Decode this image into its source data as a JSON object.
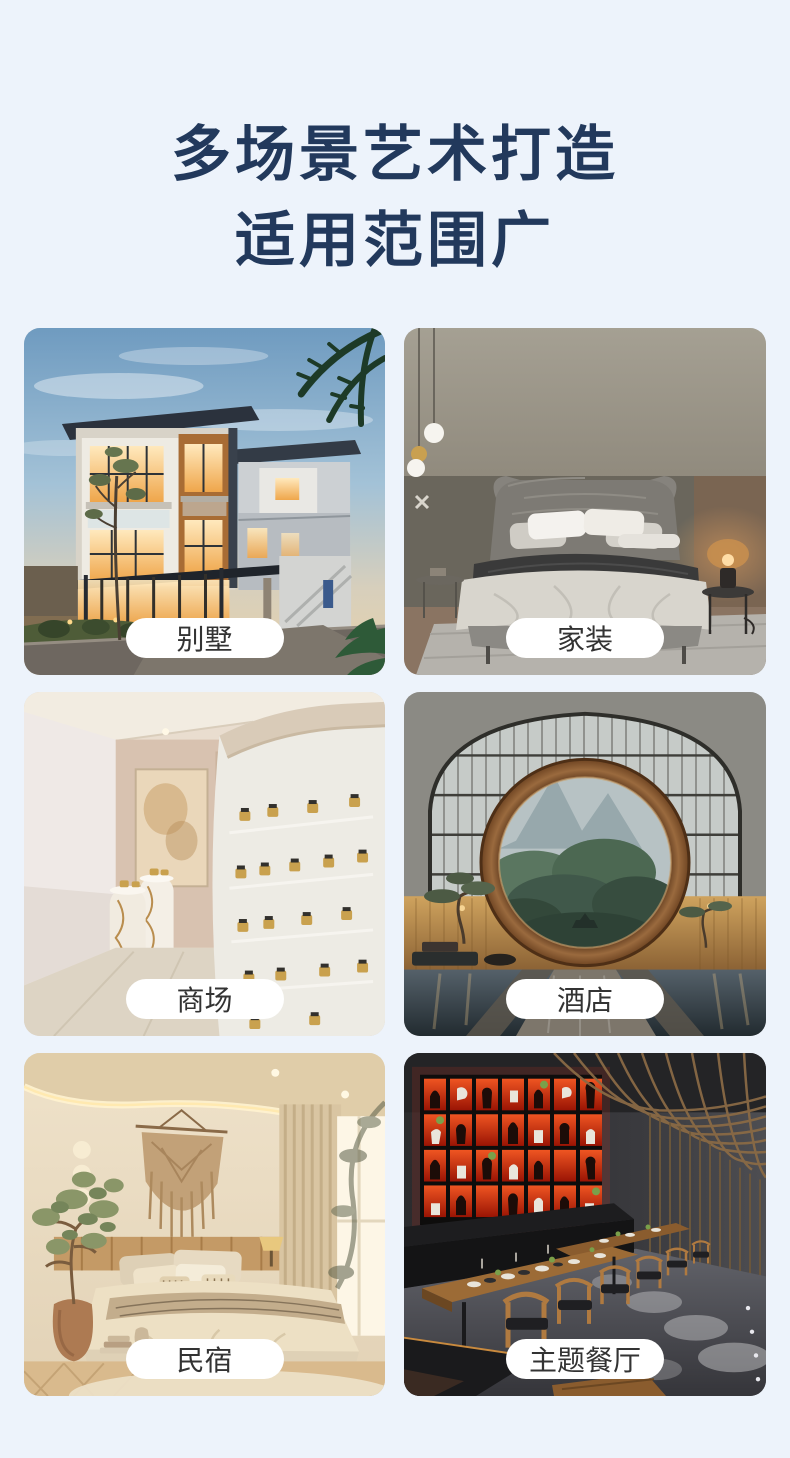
{
  "header": {
    "title_line1": "多场景艺术打造",
    "title_line2": "适用范围广"
  },
  "cards": [
    {
      "id": "villa",
      "label": "别墅",
      "image": "modern-villa-exterior-at-dusk"
    },
    {
      "id": "home-decor",
      "label": "家装",
      "image": "gray-bedroom-with-upholstered-bed"
    },
    {
      "id": "mall",
      "label": "商场",
      "image": "cream-retail-store-curved-display-wall"
    },
    {
      "id": "hotel",
      "label": "酒店",
      "image": "hotel-lobby-moon-gate-window"
    },
    {
      "id": "homestay",
      "label": "民宿",
      "image": "warm-beige-homestay-bedroom"
    },
    {
      "id": "theme-restaurant",
      "label": "主题餐厅",
      "image": "dark-theme-restaurant-red-lit-display"
    }
  ],
  "colors": {
    "page_background": "#edf3fb",
    "title_text": "#22395c",
    "pill_background": "#ffffff",
    "pill_text": "#333333"
  }
}
